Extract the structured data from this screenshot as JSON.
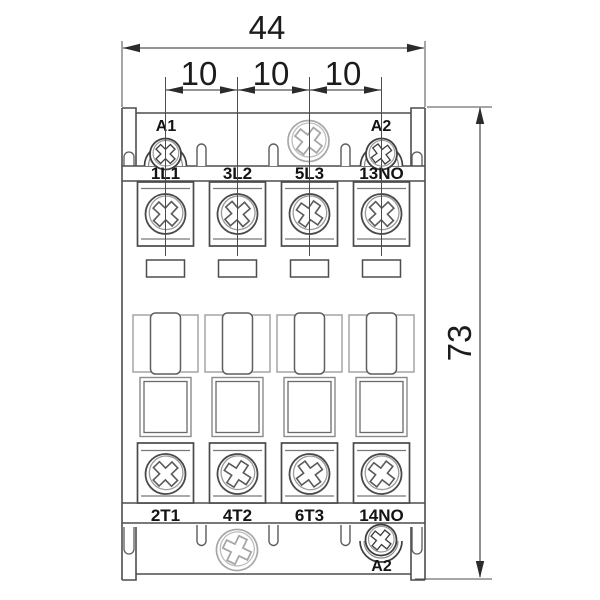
{
  "diagram": {
    "title": "contactor front-view dimensional drawing",
    "dimensions": {
      "overall_width": "44",
      "overall_height": "73",
      "pole_pitch": [
        "10",
        "10",
        "10"
      ]
    },
    "coil_terminals": {
      "top_left": "A1",
      "top_right": "A2",
      "bottom_right": "A2"
    },
    "top_terminals": [
      "1L1",
      "3L2",
      "5L3",
      "13NO"
    ],
    "bottom_terminals": [
      "2T1",
      "4T2",
      "6T3",
      "14NO"
    ],
    "line_color": "#4d4d4d",
    "dimension_color": "#2b2b2b"
  }
}
